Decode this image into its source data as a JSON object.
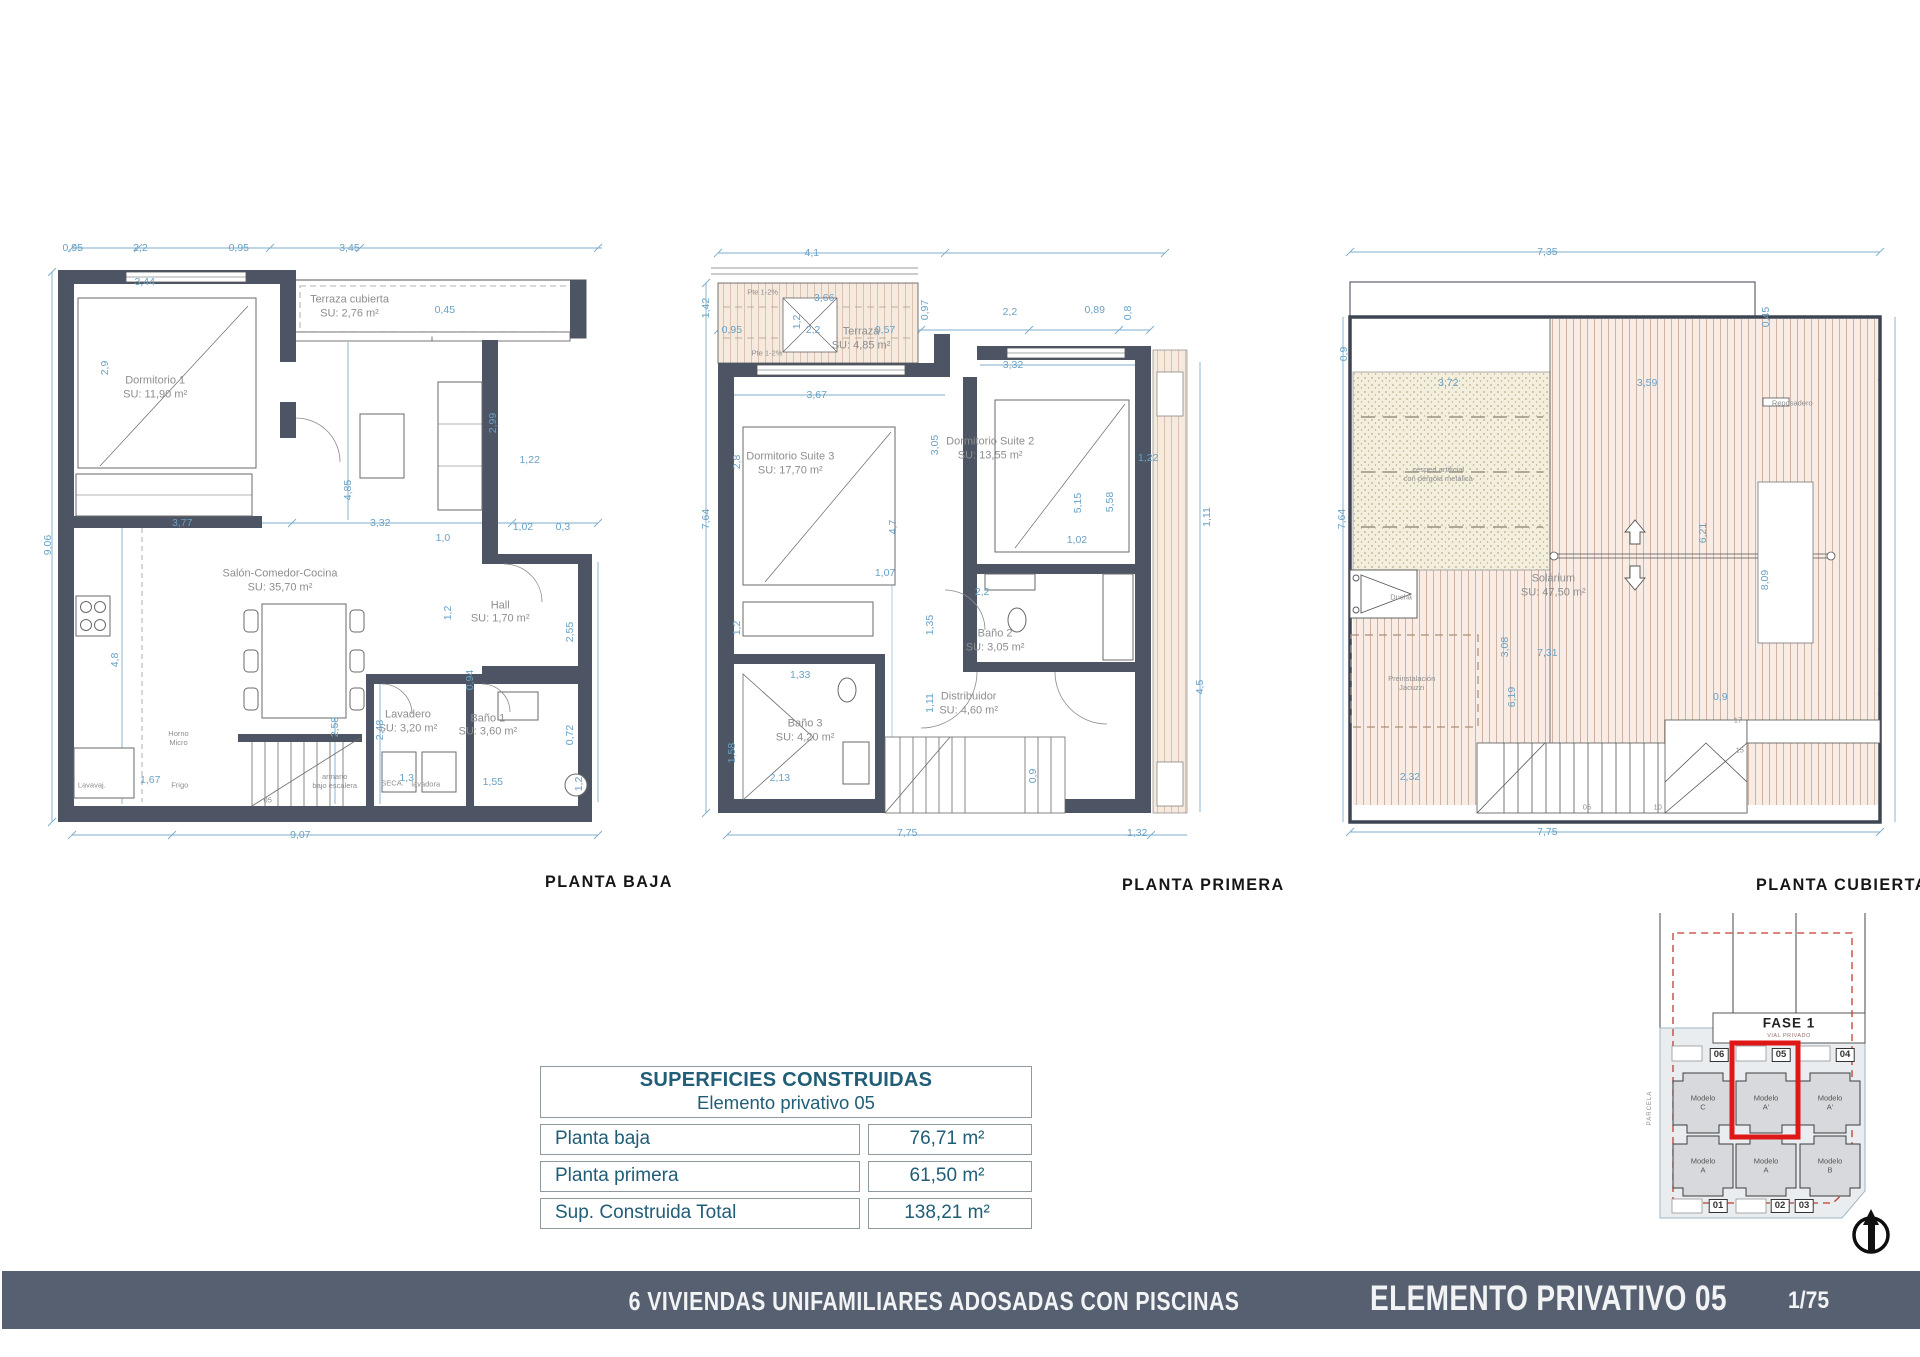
{
  "sheet": {
    "footer": {
      "project": "6 VIVIENDAS UNIFAMILIARES ADOSADAS CON PISCINAS",
      "sheet_title": "ELEMENTO PRIVATIVO 05",
      "page": "1/75"
    },
    "colors": {
      "wall": "#4d5564",
      "dimension": "#69a1c4",
      "room_text": "#8e8e8e",
      "table_text": "#205d76",
      "footer_bg": "#576070",
      "highlight_red": "#e01717",
      "terrace_fill": "#f6e9dd",
      "deck_fill": "#f8ece5",
      "grass_fill": "#f4efdc"
    }
  },
  "plans": [
    {
      "id": "baja",
      "title": "PLANTA BAJA",
      "rooms": [
        {
          "name": "Dormitorio 1",
          "su": "SU: 11,90 m²",
          "x": 18.4,
          "y": 25.2
        },
        {
          "name": "Terraza cubierta",
          "su": "SU: 2,76 m²",
          "x": 50,
          "y": 12.9
        },
        {
          "name": "Salón-Comedor-Cocina",
          "su": "SU: 35,70 m²",
          "x": 38.7,
          "y": 54.4
        },
        {
          "name": "Hall",
          "su": "SU: 1,70 m²",
          "x": 74.5,
          "y": 59.2
        },
        {
          "name": "Lavadero",
          "su": "SU: 3,20 m²",
          "x": 59.5,
          "y": 75.8
        },
        {
          "name": "Baño 1",
          "su": "SU: 3,60 m²",
          "x": 72.5,
          "y": 76.3
        }
      ],
      "dims": [
        {
          "t": "0,95",
          "x": 5,
          "y": 3.9
        },
        {
          "t": "2,2",
          "x": 16,
          "y": 3.9
        },
        {
          "t": "0,95",
          "x": 32,
          "y": 3.9
        },
        {
          "t": "3,45",
          "x": 50,
          "y": 3.9
        },
        {
          "t": "3,44",
          "x": 16.7,
          "y": 9.1
        },
        {
          "t": "0,45",
          "x": 65.5,
          "y": 13.3
        },
        {
          "t": "2,9",
          "x": 10.2,
          "y": 22.1,
          "r": 1
        },
        {
          "t": "2,99",
          "x": 73.3,
          "y": 30.5,
          "r": 1
        },
        {
          "t": "1,22",
          "x": 79.3,
          "y": 36.1
        },
        {
          "t": "9,06",
          "x": 1,
          "y": 49,
          "r": 1
        },
        {
          "t": "4,85",
          "x": 49.8,
          "y": 40.6,
          "r": 1
        },
        {
          "t": "3,77",
          "x": 22.8,
          "y": 45.6
        },
        {
          "t": "3,32",
          "x": 55,
          "y": 45.6
        },
        {
          "t": "1,0",
          "x": 65.2,
          "y": 47.9
        },
        {
          "t": "1,02",
          "x": 78.2,
          "y": 46.2
        },
        {
          "t": "0,3",
          "x": 84.7,
          "y": 46.2
        },
        {
          "t": "1,2",
          "x": 66,
          "y": 59.2,
          "r": 1
        },
        {
          "t": "2,55",
          "x": 85.8,
          "y": 62.1,
          "r": 1
        },
        {
          "t": "4,8",
          "x": 11.9,
          "y": 66.4,
          "r": 1
        },
        {
          "t": "0,94",
          "x": 69.6,
          "y": 69.4,
          "r": 1
        },
        {
          "t": "2,58",
          "x": 47.6,
          "y": 76.5,
          "r": 1
        },
        {
          "t": "2,48",
          "x": 55,
          "y": 77,
          "r": 1
        },
        {
          "t": "0,72",
          "x": 85.8,
          "y": 77.7,
          "r": 1
        },
        {
          "t": "1,67",
          "x": 17.6,
          "y": 84.5
        },
        {
          "t": "1,3",
          "x": 59.3,
          "y": 84.2
        },
        {
          "t": "1,55",
          "x": 73.3,
          "y": 84.8
        },
        {
          "t": "9,07",
          "x": 42,
          "y": 92.9
        },
        {
          "t": "1,2",
          "x": 87.3,
          "y": 85.2,
          "r": 1
        }
      ],
      "notes": [
        {
          "t": "Horno\nMicro",
          "x": 22.2,
          "y": 78.2
        },
        {
          "t": "Frigo",
          "x": 22.4,
          "y": 85.3
        },
        {
          "t": "armario\nbajo escalera",
          "x": 47.6,
          "y": 84.7
        },
        {
          "t": "SECA.",
          "x": 57,
          "y": 85
        },
        {
          "t": "lavadora",
          "x": 62.4,
          "y": 85.2
        },
        {
          "t": "Lavavaj.",
          "x": 8.1,
          "y": 85.3
        },
        {
          "t": "05",
          "x": 36.7,
          "y": 87.6
        }
      ]
    },
    {
      "id": "primera",
      "title": "PLANTA PRIMERA",
      "rooms": [
        {
          "name": "Terraza",
          "su": "SU: 4,85 m²",
          "x": 27,
          "y": 17.7
        },
        {
          "name": "Dormitorio Suite 3",
          "su": "SU: 17,70 m²",
          "x": 15.5,
          "y": 36.7
        },
        {
          "name": "Dormitorio Suite 2",
          "su": "SU: 13,55 m²",
          "x": 48,
          "y": 34.4
        },
        {
          "name": "Baño 2",
          "su": "SU: 3,05 m²",
          "x": 48.8,
          "y": 63.5
        },
        {
          "name": "Distribuidor",
          "su": "SU: 4,60 m²",
          "x": 44.5,
          "y": 73
        },
        {
          "name": "Baño 3",
          "su": "SU: 4,20 m²",
          "x": 17.9,
          "y": 77.1
        }
      ],
      "dims": [
        {
          "t": "4,1",
          "x": 19,
          "y": 4.7
        },
        {
          "t": "1,42",
          "x": 1.8,
          "y": 13,
          "r": 1
        },
        {
          "t": "3,66",
          "x": 21,
          "y": 11.5
        },
        {
          "t": "0,95",
          "x": 6,
          "y": 16.4
        },
        {
          "t": "2,2",
          "x": 19.2,
          "y": 16.4
        },
        {
          "t": "0,57",
          "x": 30.9,
          "y": 16.4
        },
        {
          "t": "1,2",
          "x": 16.6,
          "y": 15.2,
          "r": 1
        },
        {
          "t": "0,97",
          "x": 37.4,
          "y": 13.3,
          "r": 1
        },
        {
          "t": "2,2",
          "x": 51.2,
          "y": 13.6
        },
        {
          "t": "0,89",
          "x": 65,
          "y": 13.3
        },
        {
          "t": "0,8",
          "x": 70.4,
          "y": 13.8,
          "r": 1
        },
        {
          "t": "3,32",
          "x": 51.7,
          "y": 21.7
        },
        {
          "t": "3,67",
          "x": 19.8,
          "y": 26.2
        },
        {
          "t": "3,05",
          "x": 39,
          "y": 33.8,
          "r": 1
        },
        {
          "t": "2,8",
          "x": 6.8,
          "y": 36.4,
          "r": 1
        },
        {
          "t": "7,64",
          "x": 1.8,
          "y": 45,
          "r": 1
        },
        {
          "t": "4,7",
          "x": 32.2,
          "y": 46.2,
          "r": 1
        },
        {
          "t": "5,15",
          "x": 62.3,
          "y": 42.6,
          "r": 1
        },
        {
          "t": "5,58",
          "x": 67.5,
          "y": 42.4,
          "r": 1
        },
        {
          "t": "1,22",
          "x": 73.7,
          "y": 35.8
        },
        {
          "t": "1,11",
          "x": 83.3,
          "y": 44.7,
          "r": 1
        },
        {
          "t": "1,02",
          "x": 62.1,
          "y": 48.2
        },
        {
          "t": "1,07",
          "x": 30.9,
          "y": 53.2
        },
        {
          "t": "2,2",
          "x": 46.7,
          "y": 56
        },
        {
          "t": "1,35",
          "x": 38.2,
          "y": 61,
          "r": 1
        },
        {
          "t": "1,2",
          "x": 6.8,
          "y": 61.5,
          "r": 1
        },
        {
          "t": "1,33",
          "x": 17.1,
          "y": 68.6
        },
        {
          "t": "1,11",
          "x": 38.2,
          "y": 72.9,
          "r": 1
        },
        {
          "t": "1,58",
          "x": 6,
          "y": 80.5,
          "r": 1
        },
        {
          "t": "2,13",
          "x": 13.8,
          "y": 84.2
        },
        {
          "t": "0,9",
          "x": 55,
          "y": 84,
          "r": 1
        },
        {
          "t": "4,5",
          "x": 82.1,
          "y": 70.4,
          "r": 1
        },
        {
          "t": "7,75",
          "x": 34.5,
          "y": 92.6
        },
        {
          "t": "1,32",
          "x": 71.9,
          "y": 92.6
        }
      ],
      "notes": [
        {
          "t": "Pte 1-2%",
          "x": 11,
          "y": 10.6
        },
        {
          "t": "Pte 1-2%",
          "x": 11.7,
          "y": 19.8
        }
      ]
    },
    {
      "id": "cubierta",
      "title": "PLANTA CUBIERTA",
      "rooms": [
        {
          "name": "Solárium",
          "su": "SU: 47,50 m²",
          "x": 37,
          "y": 55.2
        }
      ],
      "dims": [
        {
          "t": "7,35",
          "x": 36,
          "y": 4.5
        },
        {
          "t": "0,45",
          "x": 73,
          "y": 14.4,
          "r": 1
        },
        {
          "t": "0,9",
          "x": 1.5,
          "y": 20,
          "r": 1
        },
        {
          "t": "3,72",
          "x": 19.2,
          "y": 24.4
        },
        {
          "t": "3,59",
          "x": 52.9,
          "y": 24.4
        },
        {
          "t": "7,64",
          "x": 1.2,
          "y": 45,
          "r": 1
        },
        {
          "t": "6,21",
          "x": 62.4,
          "y": 47.1,
          "r": 1
        },
        {
          "t": "8,09",
          "x": 72.9,
          "y": 54.2,
          "r": 1
        },
        {
          "t": "3,08",
          "x": 28.8,
          "y": 64.4,
          "r": 1
        },
        {
          "t": "7,31",
          "x": 36,
          "y": 65.3
        },
        {
          "t": "6,19",
          "x": 30,
          "y": 72,
          "r": 1
        },
        {
          "t": "0,9",
          "x": 65.3,
          "y": 72
        },
        {
          "t": "2,32",
          "x": 12.7,
          "y": 84.1
        },
        {
          "t": "7,75",
          "x": 36,
          "y": 92.4
        }
      ],
      "notes": [
        {
          "t": "césped artificial\ncon pérgola metálica",
          "x": 17.5,
          "y": 38.2
        },
        {
          "t": "Preinstalación\nJacuzzi",
          "x": 13,
          "y": 69.8
        },
        {
          "t": "Ducha",
          "x": 11.2,
          "y": 56.8
        },
        {
          "t": "Reposadero",
          "x": 77.5,
          "y": 27.4
        },
        {
          "t": "17",
          "x": 68.3,
          "y": 75.5
        },
        {
          "t": "15",
          "x": 68.6,
          "y": 80
        },
        {
          "t": "05",
          "x": 42.7,
          "y": 88.6
        },
        {
          "t": "10",
          "x": 54.7,
          "y": 88.6
        }
      ]
    }
  ],
  "summary_table": {
    "title": "SUPERFICIES CONSTRUIDAS",
    "subtitle": "Elemento privativo 05",
    "rows": [
      {
        "label": "Planta baja",
        "value": "76,71 m²"
      },
      {
        "label": "Planta primera",
        "value": "61,50 m²"
      },
      {
        "label": "Sup. Construida Total",
        "value": "138,21 m²"
      }
    ]
  },
  "site_plan": {
    "fase": "FASE 1",
    "vial": "VIAL PRIVADO",
    "parcela": "PARCELA",
    "units": [
      {
        "num": "06",
        "model": "Modelo\nC"
      },
      {
        "num": "05",
        "model": "Modelo\nA'"
      },
      {
        "num": "04",
        "model": "Modelo\nA'"
      },
      {
        "num": "01",
        "model": "Modelo\nA"
      },
      {
        "num": "02",
        "model": "Modelo\nA"
      },
      {
        "num": "03",
        "model": "Modelo\nB"
      }
    ]
  }
}
